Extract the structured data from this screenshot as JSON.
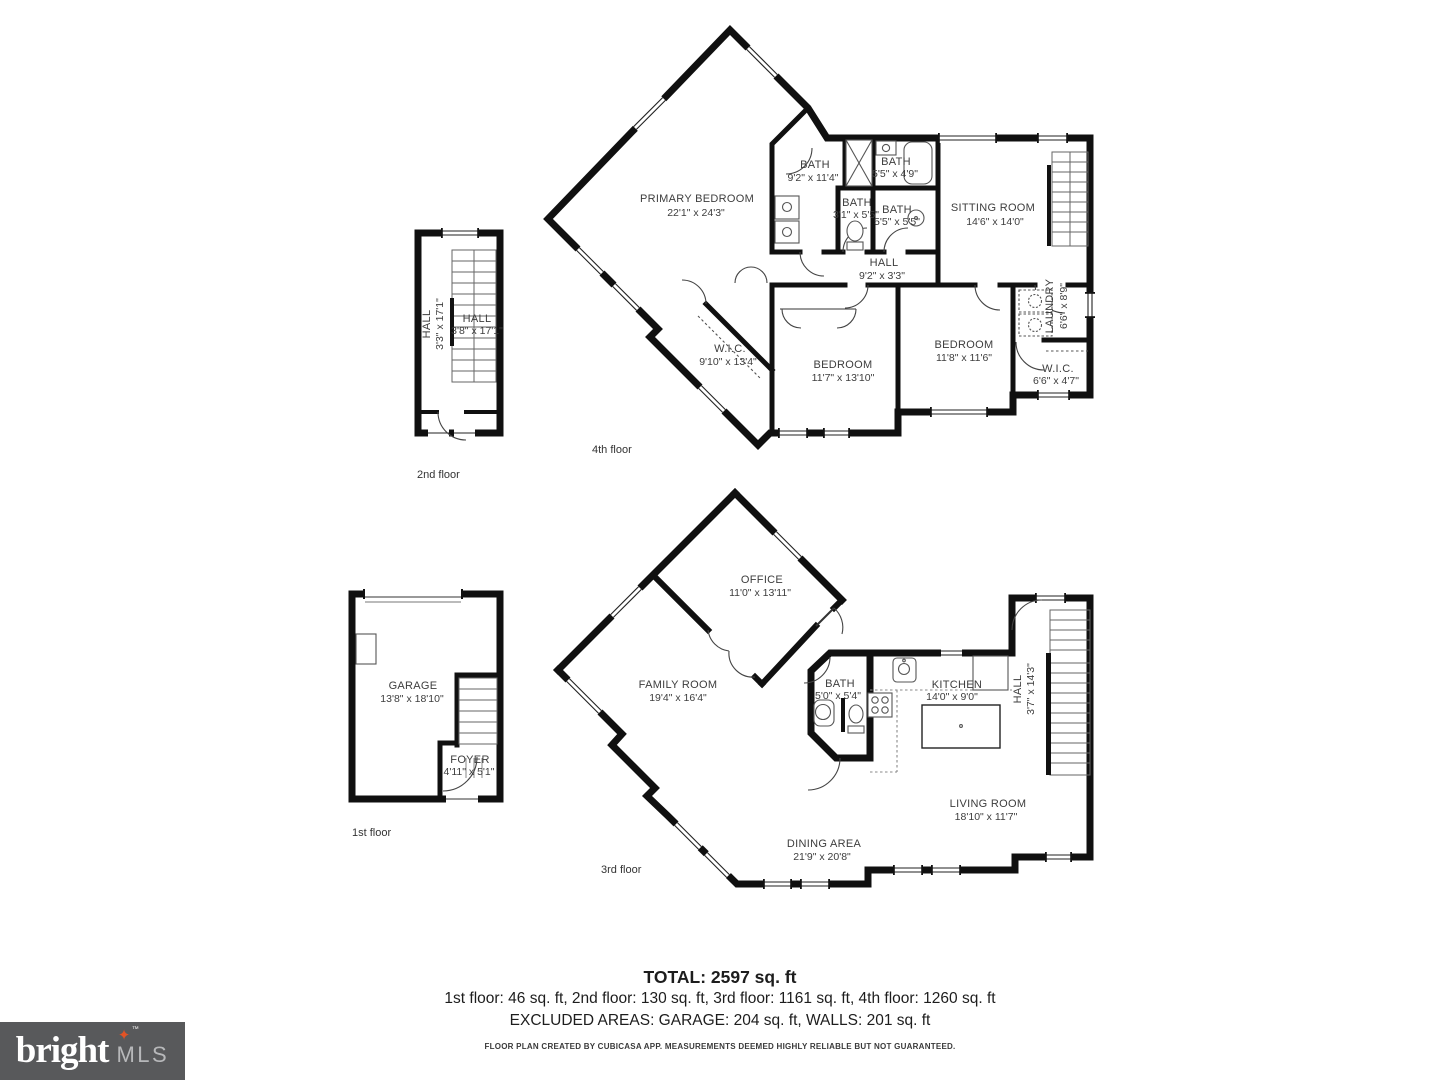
{
  "floors": {
    "f4": {
      "caption": "4th floor",
      "rooms": {
        "primary": {
          "name": "PRIMARY BEDROOM",
          "dims": "22'1\" x 24'3\""
        },
        "bath1": {
          "name": "BATH",
          "dims": "9'2\" x 11'4\""
        },
        "bath2": {
          "name": "BATH",
          "dims": "5'5\" x 4'9\""
        },
        "bath3": {
          "name": "BATH",
          "dims": "3'1\" x 5'5\""
        },
        "bath4": {
          "name": "BATH",
          "dims": "5'5\" x 5'5\""
        },
        "sitting": {
          "name": "SITTING ROOM",
          "dims": "14'6\" x 14'0\""
        },
        "hall": {
          "name": "HALL",
          "dims": "9'2\" x 3'3\""
        },
        "wic1": {
          "name": "W.I.C.",
          "dims": "9'10\" x 13'4\""
        },
        "bedroom1": {
          "name": "BEDROOM",
          "dims": "11'7\" x 13'10\""
        },
        "bedroom2": {
          "name": "BEDROOM",
          "dims": "11'8\" x 11'6\""
        },
        "laundry": {
          "name": "LAUNDRY",
          "dims": "6'6\" x 8'9\""
        },
        "wic2": {
          "name": "W.I.C.",
          "dims": "6'6\" x 4'7\""
        }
      }
    },
    "f3": {
      "caption": "3rd floor",
      "rooms": {
        "office": {
          "name": "OFFICE",
          "dims": "11'0\" x 13'11\""
        },
        "family": {
          "name": "FAMILY ROOM",
          "dims": "19'4\" x 16'4\""
        },
        "bath": {
          "name": "BATH",
          "dims": "5'0\" x 5'4\""
        },
        "kitchen": {
          "name": "KITCHEN",
          "dims": "14'0\" x 9'0\""
        },
        "hall": {
          "name": "HALL",
          "dims": "3'7\" x 14'3\""
        },
        "living": {
          "name": "LIVING ROOM",
          "dims": "18'10\" x 11'7\""
        },
        "dining": {
          "name": "DINING AREA",
          "dims": "21'9\" x 20'8\""
        }
      }
    },
    "f2": {
      "caption": "2nd floor",
      "rooms": {
        "hall_left": {
          "name": "HALL",
          "dims": "3'3\" x 17'1\""
        },
        "hall_right": {
          "name": "HALL",
          "dims": "3'8\" x 17'1\""
        }
      }
    },
    "f1": {
      "caption": "1st floor",
      "rooms": {
        "garage": {
          "name": "GARAGE",
          "dims": "13'8\" x 18'10\""
        },
        "foyer": {
          "name": "FOYER",
          "dims": "4'11\" x 5'1\""
        }
      }
    }
  },
  "footer": {
    "total": "TOTAL: 2597 sq. ft",
    "floors": "1st floor: 46 sq. ft, 2nd floor: 130 sq. ft, 3rd floor: 1161 sq. ft, 4th floor: 1260 sq. ft",
    "excluded": "EXCLUDED AREAS: GARAGE: 204 sq. ft, WALLS: 201 sq. ft",
    "disclaimer": "FLOOR PLAN CREATED BY CUBICASA APP. MEASUREMENTS DEEMED HIGHLY RELIABLE BUT NOT GUARANTEED."
  },
  "logo": {
    "brand": "bright",
    "suffix": "MLS",
    "tm": "™",
    "star": "✦",
    "bg_color": "#58595b",
    "star_color": "#e25325"
  },
  "colors": {
    "wall": "#101010",
    "label": "#3d3d3d"
  }
}
